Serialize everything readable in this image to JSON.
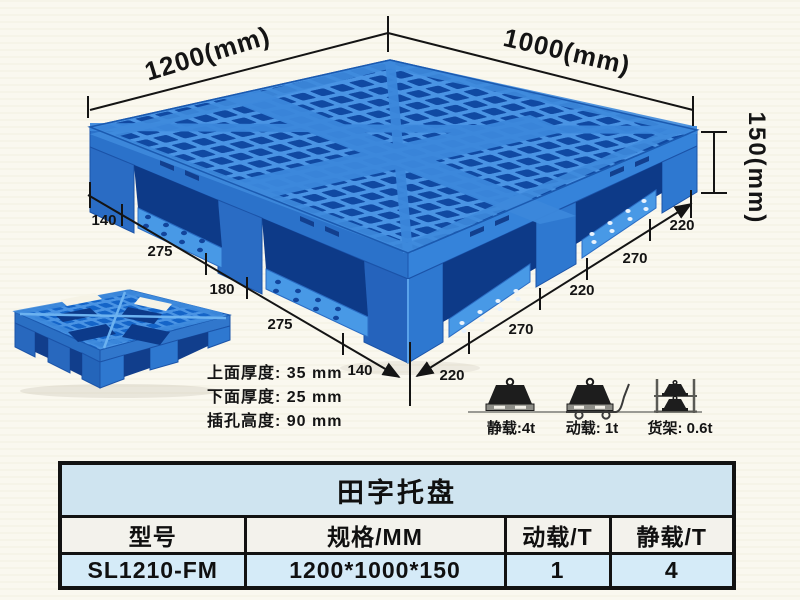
{
  "diagram": {
    "width_label": "1200(mm)",
    "depth_label": "1000(mm)",
    "height_label": "150(mm)",
    "left_edge_segments": [
      "140",
      "275",
      "180",
      "275",
      "140"
    ],
    "right_edge_segments": [
      "220",
      "270",
      "220",
      "270",
      "220"
    ],
    "thickness_notes": [
      "上面厚度: 35 mm",
      "下面厚度: 25 mm",
      "插孔高度: 90 mm"
    ]
  },
  "load_ratings": {
    "static_label": "静载:4t",
    "dynamic_label": "动载: 1t",
    "rack_label": "货架: 0.6t"
  },
  "table": {
    "title": "田字托盘",
    "headers": [
      "型号",
      "规格/MM",
      "动载/T",
      "静载/T"
    ],
    "row": [
      "SL1210-FM",
      "1200*1000*150",
      "1",
      "4"
    ]
  },
  "colors": {
    "pallet_blue": "#2f7cd4",
    "pallet_dark_hole": "#0f47a0",
    "pallet_light_rib": "#4f9ee8",
    "table_title_bg": "#cfe4f0",
    "table_header_bg": "#f3f2ec",
    "table_row_bg": "#d5ebf8",
    "annotation_color": "#141414",
    "background": "#faf8ef"
  }
}
